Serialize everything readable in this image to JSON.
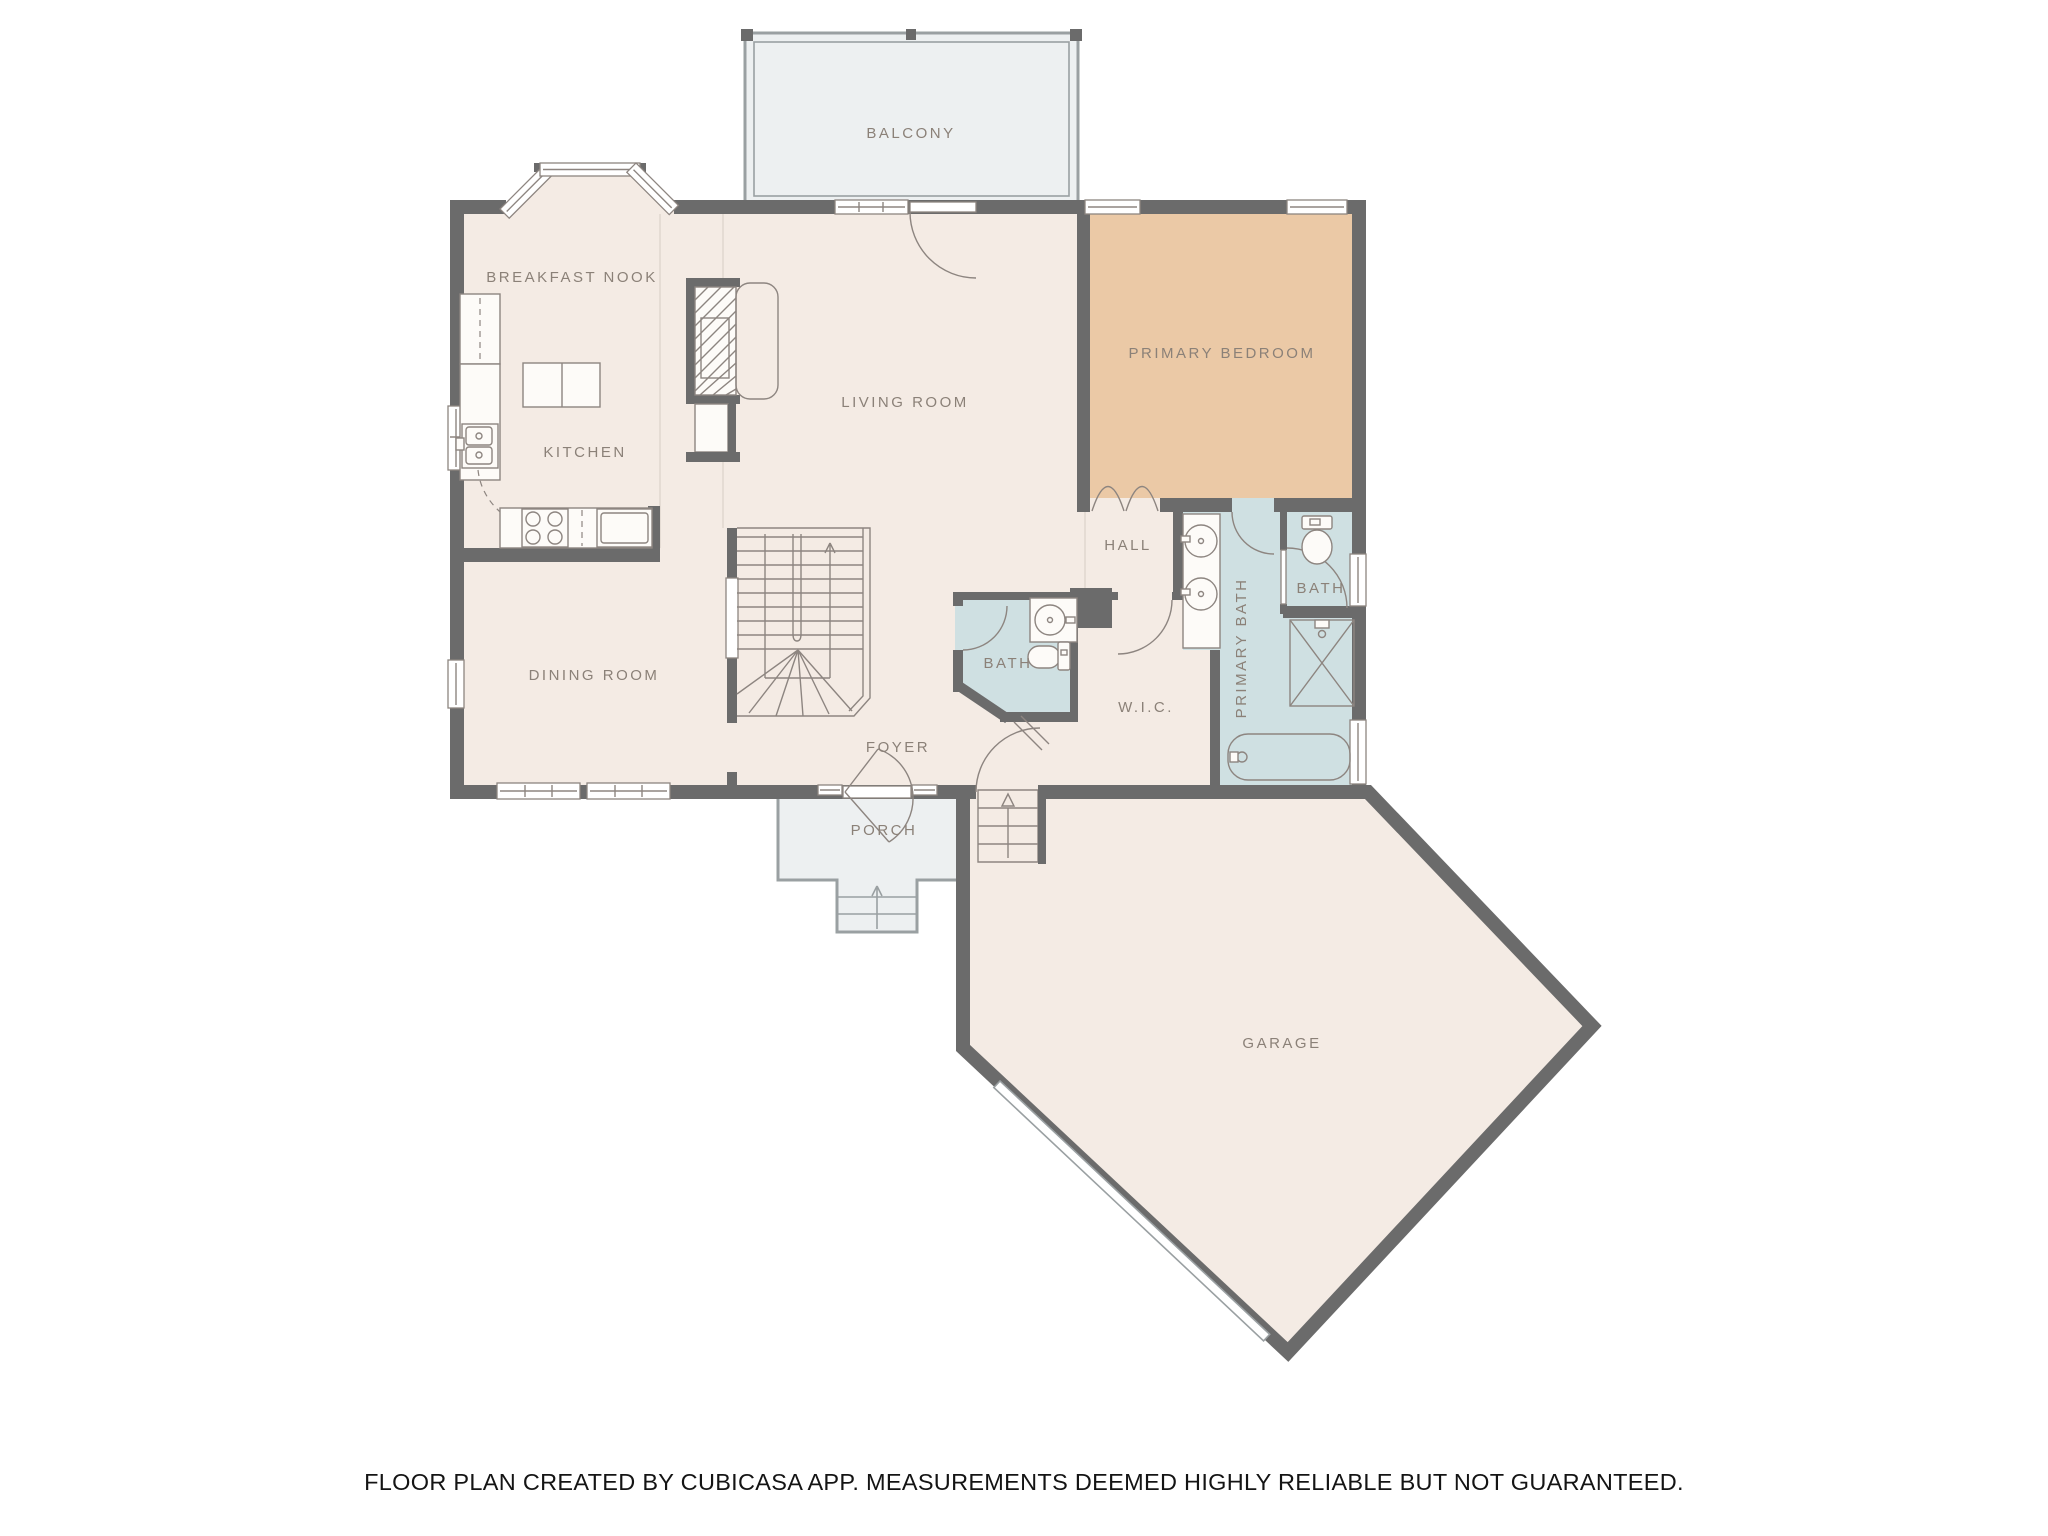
{
  "colors": {
    "background": "#ffffff",
    "floor": "#f4ebe4",
    "bedroom": "#ebc9a6",
    "bath": "#cfe0e2",
    "outdoor": "#edf0f1",
    "wall": "#6b6b6b",
    "line": "#8d8580",
    "outdoor_line": "#9aa0a2",
    "label": "#8b8178",
    "seam": "#e5dcd4",
    "footer_text": "#141414"
  },
  "rooms": {
    "balcony": {
      "label": "BALCONY"
    },
    "breakfast_nook": {
      "label": "BREAKFAST NOOK"
    },
    "kitchen": {
      "label": "KITCHEN"
    },
    "living_room": {
      "label": "LIVING ROOM"
    },
    "primary_bedroom": {
      "label": "PRIMARY BEDROOM"
    },
    "dining_room": {
      "label": "DINING ROOM"
    },
    "hall": {
      "label": "HALL"
    },
    "primary_bath": {
      "label": "PRIMARY BATH"
    },
    "hall_bath": {
      "label": "BATH"
    },
    "foyer_bath": {
      "label": "BATH"
    },
    "wic": {
      "label": "W.I.C."
    },
    "foyer": {
      "label": "FOYER"
    },
    "porch": {
      "label": "PORCH"
    },
    "garage": {
      "label": "GARAGE"
    }
  },
  "footer": {
    "disclaimer": "FLOOR PLAN CREATED BY CUBICASA APP. MEASUREMENTS DEEMED HIGHLY RELIABLE BUT NOT GUARANTEED."
  }
}
